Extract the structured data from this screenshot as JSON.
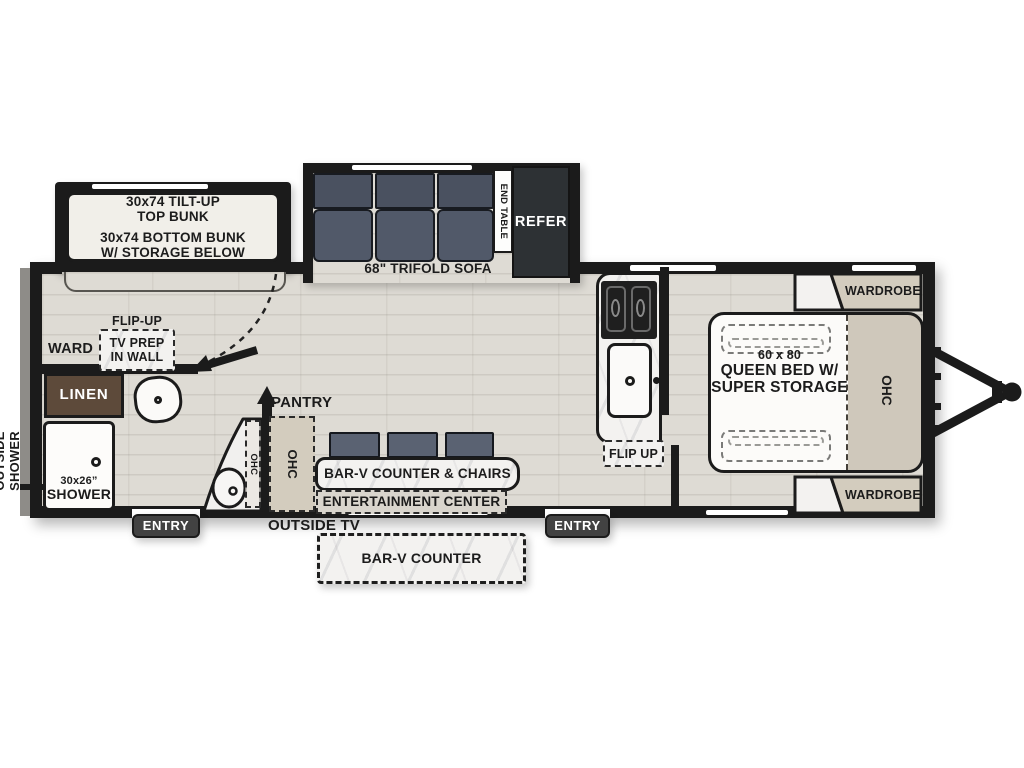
{
  "title": "travel-trailer-floorplan",
  "colors": {
    "wall": "#1b1b1b",
    "floor_wood": "#dedbd4",
    "marble": "#f3f2f0",
    "cabinet_tan": "#d3ccbe",
    "sofa_dark": "#4a5160",
    "refer_dark": "#2d3134",
    "linen_brown": "#5d4a3a",
    "entry_gray": "#424242"
  },
  "bunk": {
    "line1": "30x74 TILT-UP",
    "line2": "TOP BUNK",
    "line3": "30x74 BOTTOM BUNK",
    "line4": "W/ STORAGE BELOW"
  },
  "sofa": {
    "label": "68\" TRIFOLD SOFA",
    "end_table": "END TABLE",
    "refer": "REFER"
  },
  "bath": {
    "outside_shower_line1": "OUTSIDE",
    "outside_shower_line2": "SHOWER",
    "ward": "WARD",
    "flip_up": "FLIP-UP",
    "tv_prep_line1": "TV PREP",
    "tv_prep_line2": "IN WALL",
    "linen": "LINEN",
    "vanity_ohc": "OHC",
    "shower_size": "30x26”",
    "shower": "SHOWER"
  },
  "galley": {
    "pantry": "PANTRY",
    "pantry_ohc": "OHC",
    "bar_counter": "BAR-V COUNTER & CHAIRS",
    "entertainment": "ENTERTAINMENT CENTER",
    "outside_tv": "OUTSIDE TV",
    "outside_counter": "BAR-V COUNTER",
    "flip_up": "FLIP UP"
  },
  "entries": {
    "left": "ENTRY",
    "right": "ENTRY"
  },
  "bedroom": {
    "wardrobe_top": "WARDROBE",
    "wardrobe_bottom": "WARDROBE",
    "bed_line1": "60 x 80",
    "bed_line2": "QUEEN BED W/",
    "bed_line3": "SUPER STORAGE",
    "ohc": "OHC"
  }
}
